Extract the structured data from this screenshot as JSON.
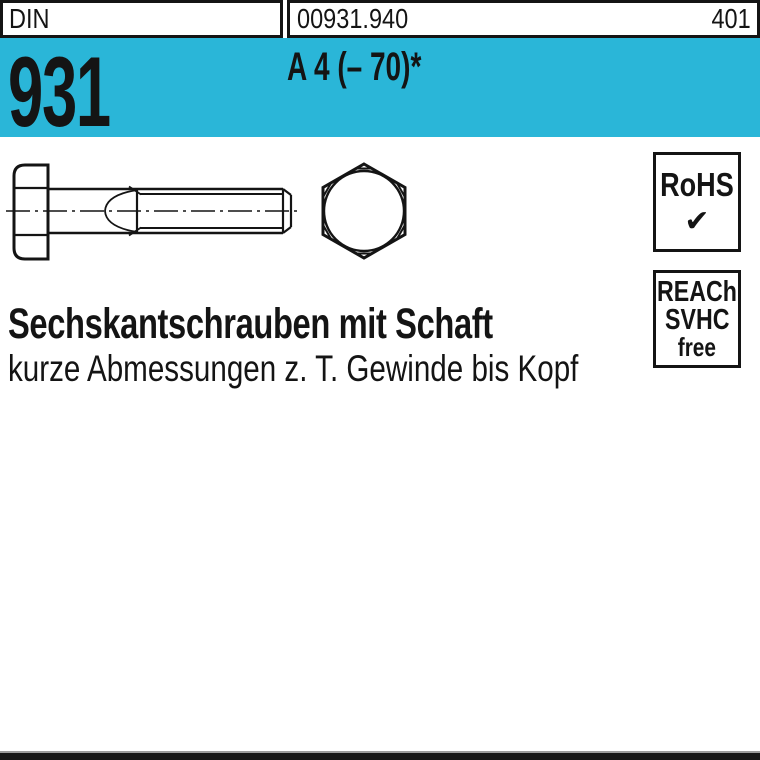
{
  "header": {
    "din_label": "DIN",
    "article_number": "00931.940",
    "page_number": "401"
  },
  "banner": {
    "standard_number": "931",
    "material_grade": "A 4 (– 70)*"
  },
  "badges": {
    "rohs": {
      "label": "RoHS",
      "check": "✔"
    },
    "reach": {
      "lines": [
        "REACh",
        "SVHC",
        "free"
      ]
    }
  },
  "description": {
    "title": "Sechskantschrauben mit Schaft",
    "subtitle": "kurze Abmessungen z. T. Gewinde bis Kopf"
  },
  "colors": {
    "accent": "#2ab6d8",
    "ink": "#141414"
  }
}
